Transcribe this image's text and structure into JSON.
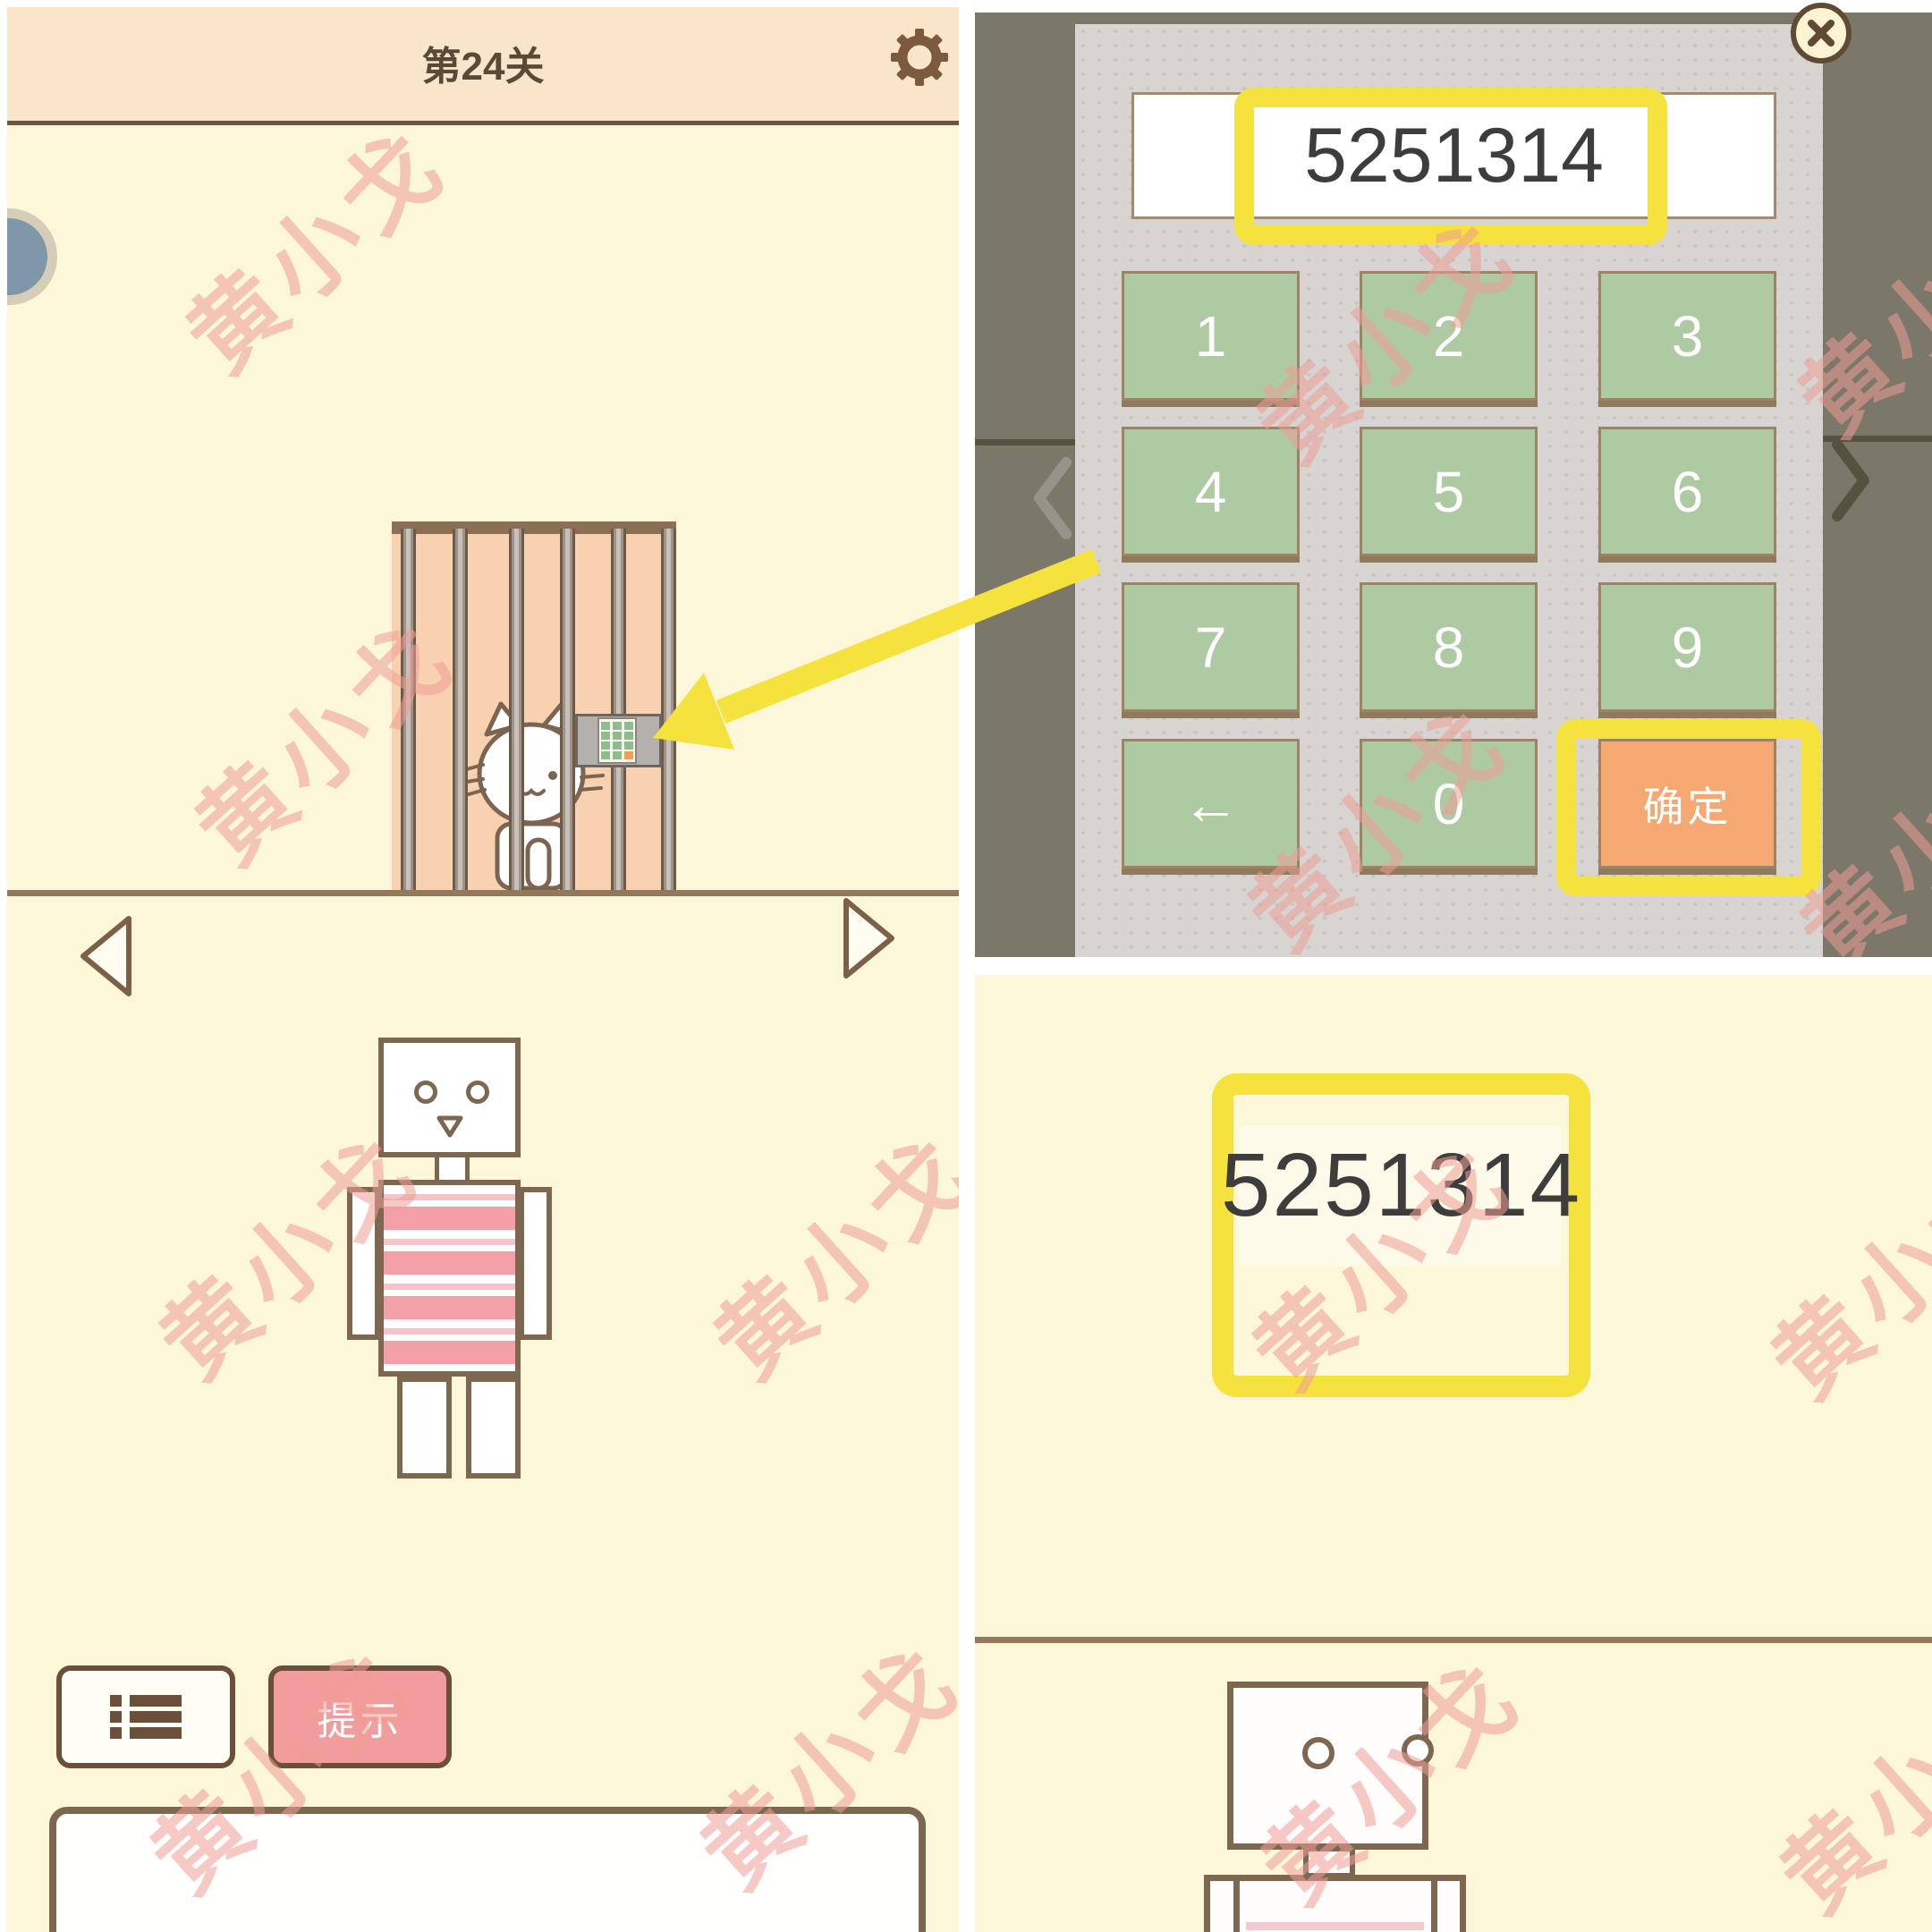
{
  "watermark": {
    "text": "黄小戈"
  },
  "colors": {
    "highlight_yellow": "#f6e23c",
    "key_green": "#aecaa3",
    "confirm_orange": "#f5a872",
    "hint_pink": "#f29d9d",
    "panel_cream": "#fcf7d9",
    "header_peach": "#f9e6ca",
    "overlay_dark": "#7b7769",
    "outline_brown": "#7d6751"
  },
  "left_screen": {
    "title": "第24关",
    "hint_button_label": "提示",
    "icons": {
      "settings": "gear-icon",
      "levels": "list-icon",
      "prev": "left-triangle-icon",
      "next": "right-triangle-icon",
      "cage_keypad": "mini-keypad-icon"
    }
  },
  "keypad_overlay": {
    "display_value": "5251314",
    "keys": [
      [
        "1",
        "2",
        "3"
      ],
      [
        "4",
        "5",
        "6"
      ],
      [
        "7",
        "8",
        "9"
      ],
      [
        "←",
        "0",
        "确定"
      ]
    ],
    "icons": {
      "close": "close-icon",
      "backspace": "backspace-arrow-icon",
      "prev": "chevron-left-icon",
      "next": "chevron-right-icon"
    }
  },
  "answer_note": {
    "value": "5251314"
  }
}
